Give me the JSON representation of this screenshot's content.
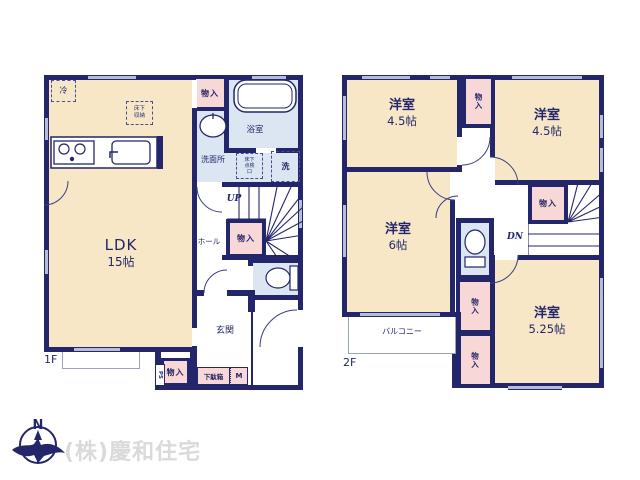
{
  "colors": {
    "wall": "#23266b",
    "room_fill": "#f7e7c6",
    "closet_fill": "#f8d8d6",
    "wet_fill": "#dbe6f2",
    "window": "#b4bed9",
    "text": "#23266b",
    "watermark": "#dadada"
  },
  "floor1": {
    "label": "1F",
    "ldk": "LDK",
    "ldk_size": "15帖",
    "fridge": "冷",
    "underfloor_storage": "床下収納",
    "closet_top": "物入",
    "bathroom": "浴室",
    "washroom": "洗面所",
    "underfloor_hatch": "床下点検口",
    "laundry": "洗",
    "up": "UP",
    "hall": "ホール",
    "closet_stairs": "物入",
    "entrance": "玄関",
    "closet_south": "物入",
    "ps": "PS",
    "shoe_box": "下駄箱",
    "meter": "M"
  },
  "floor2": {
    "label": "2F",
    "room_nw": "洋室",
    "room_nw_size": "4.5帖",
    "closet_north": "物入",
    "room_ne": "洋室",
    "room_ne_size": "4.5帖",
    "room_w": "洋室",
    "room_w_size": "6帖",
    "closet_stairs": "物入",
    "dn": "DN",
    "closet_mid": "物入",
    "closet_south": "物入",
    "room_se": "洋室",
    "room_se_size": "5.25帖",
    "balcony": "バルコニー"
  },
  "footer": {
    "compass_north": "N",
    "company": "(株)慶和住宅"
  }
}
